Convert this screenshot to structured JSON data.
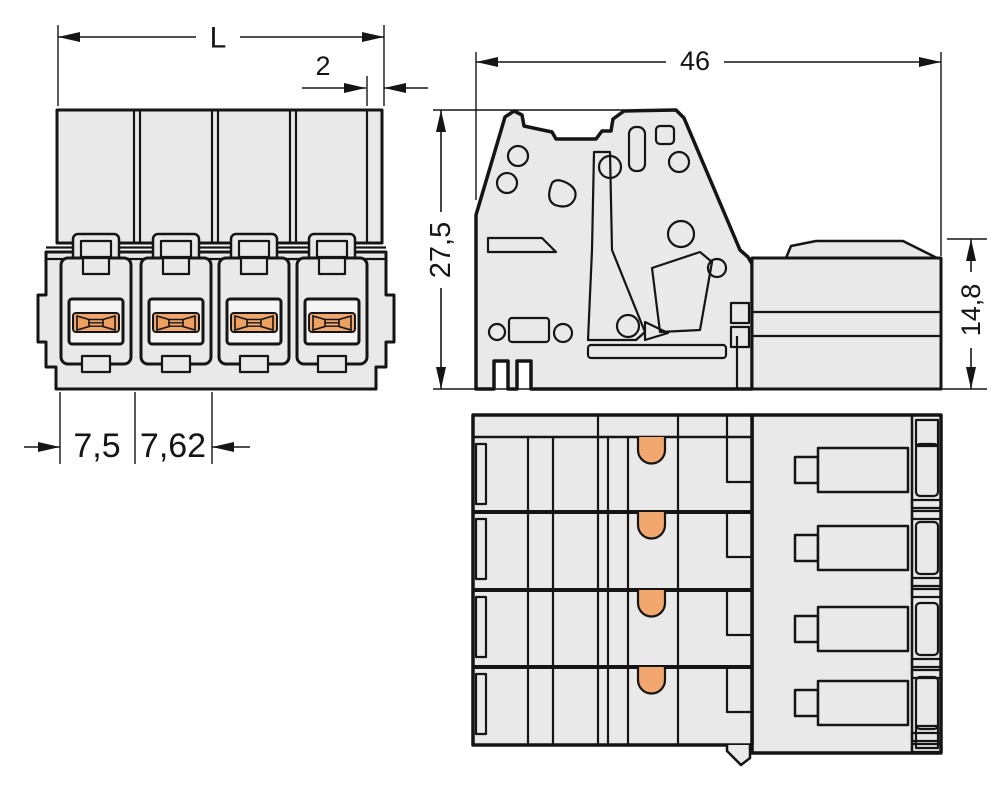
{
  "drawing": {
    "dimensions": {
      "length_L": "L",
      "end_offset": "2",
      "pitch_1": "7,5",
      "pitch_2": "7,62",
      "depth": "46",
      "height": "27,5",
      "rear_height": "14,8"
    },
    "colors": {
      "background": "#ffffff",
      "body_fill": "#e9e9e9",
      "inner_fill": "#f4f4f4",
      "outline": "#151515",
      "contact_orange": "#f2a76f",
      "contact_orange_dark": "#eda05f"
    }
  }
}
